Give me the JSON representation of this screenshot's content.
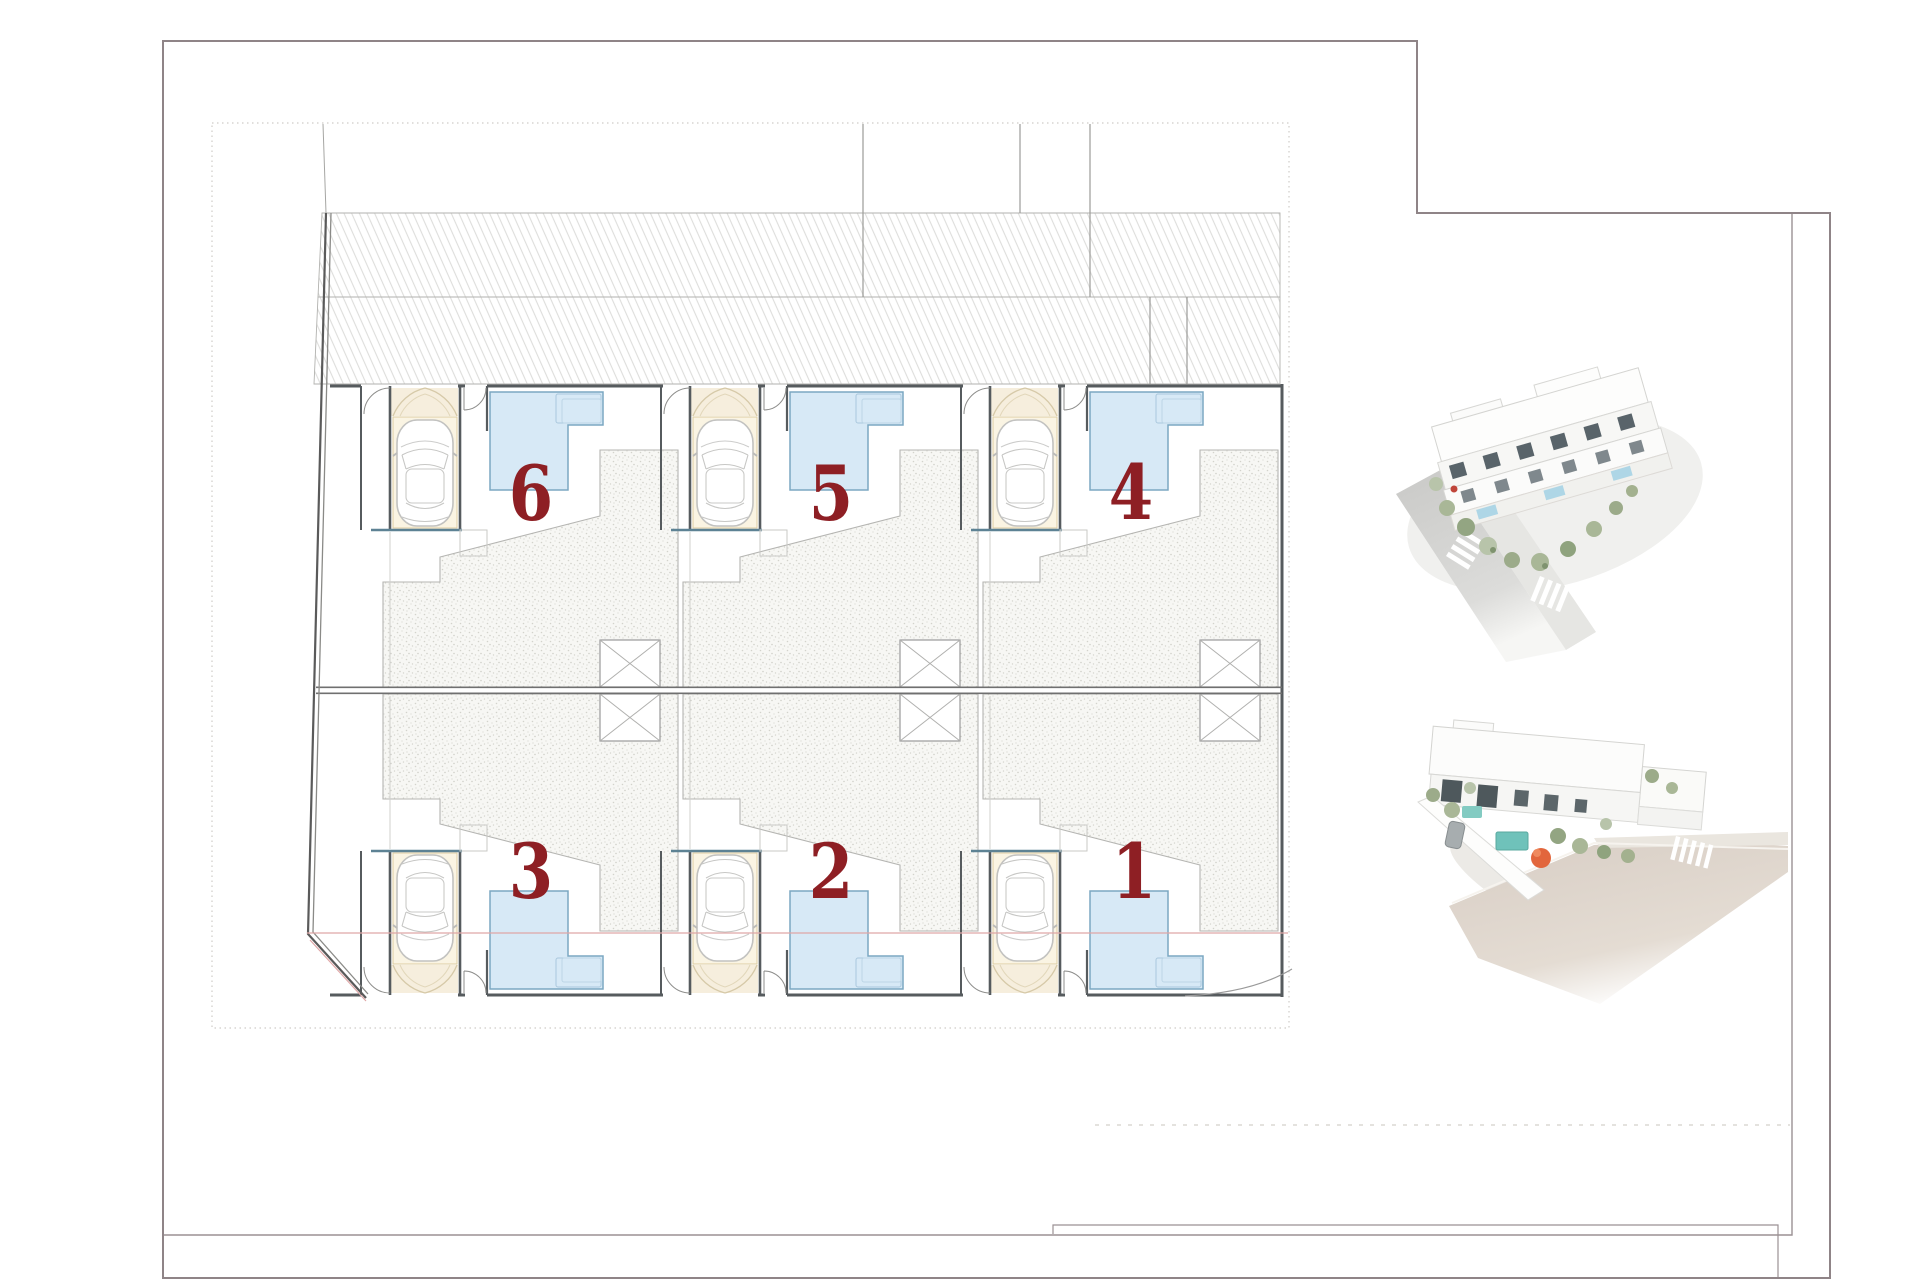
{
  "page": {
    "background": "#ffffff",
    "frame_color": "#8f8487"
  },
  "plan": {
    "number_color": "#8e1f24",
    "pool_color": "#d7e9f6",
    "units": [
      {
        "label": "6",
        "row": "top",
        "position": "left"
      },
      {
        "label": "5",
        "row": "top",
        "position": "middle"
      },
      {
        "label": "4",
        "row": "top",
        "position": "right"
      },
      {
        "label": "3",
        "row": "bottom",
        "position": "left"
      },
      {
        "label": "2",
        "row": "bottom",
        "position": "middle"
      },
      {
        "label": "1",
        "row": "bottom",
        "position": "right"
      }
    ]
  },
  "renders": {
    "top": "aerial-3d-render-street-corner",
    "bottom": "aerial-3d-render-rear-street"
  }
}
